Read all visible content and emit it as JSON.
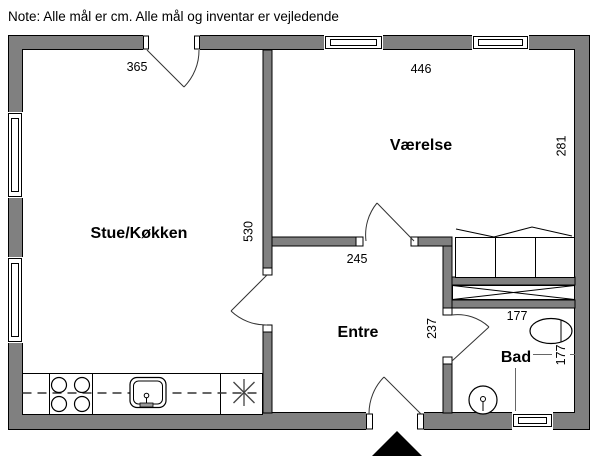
{
  "note": "Note: Alle mål er cm. Alle mål og inventar er vejledende",
  "colors": {
    "wall": "#808080",
    "background": "#ffffff",
    "line": "#000000",
    "marker": "#000000"
  },
  "rooms": {
    "stue": {
      "label": "Stue/Køkken",
      "width": "365",
      "depth": "530"
    },
    "vaerelse": {
      "label": "Værelse",
      "width": "446",
      "depth": "281"
    },
    "entre": {
      "label": "Entre",
      "width": "245",
      "depth": "237"
    },
    "bad": {
      "label": "Bad",
      "width": "177",
      "depth": "177"
    }
  },
  "icons": {
    "entrance_marker": "black-up-triangle",
    "stove": "four-burner-circles",
    "sink": "rounded-basin-with-tap",
    "appliance": "asterisk",
    "bed": "three-section-bed-with-pillows",
    "wardrobe": "crossed-rectangle",
    "toilet": "oval-with-cistern-line",
    "washbasin": "round-basin-with-tap"
  }
}
